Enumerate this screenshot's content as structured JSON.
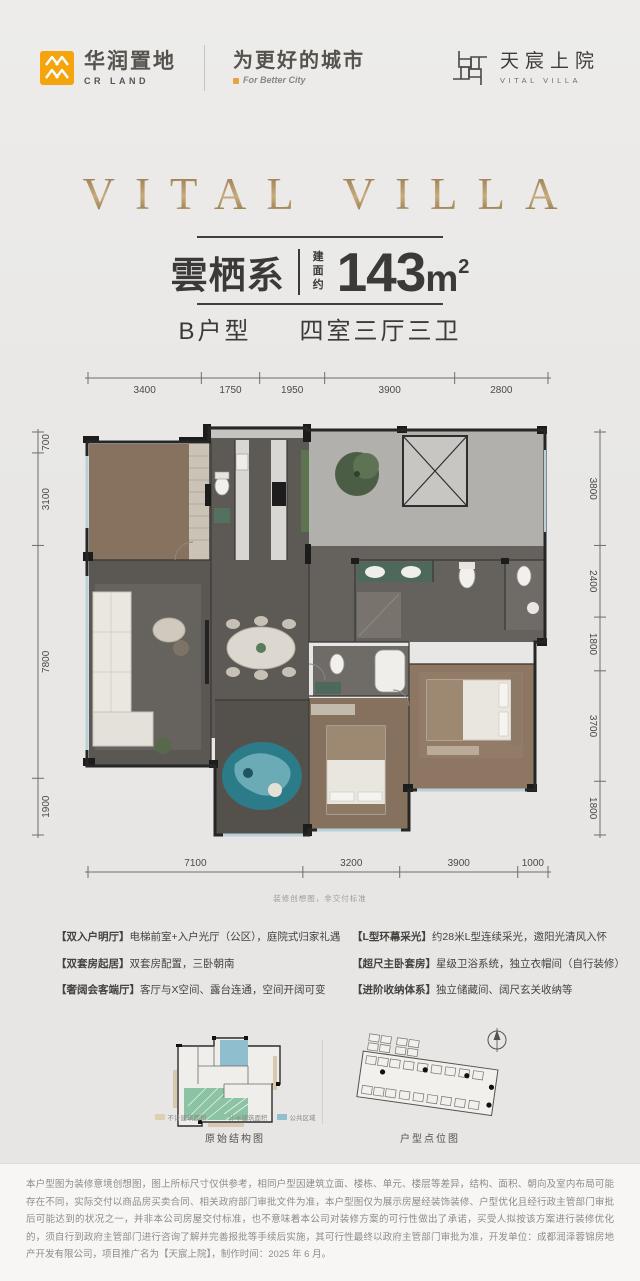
{
  "header": {
    "crland": {
      "name": "华润置地",
      "sub": "CR LAND",
      "slogan": "为更好的城市",
      "slogan_en": "For Better City"
    },
    "project": {
      "name": "天宸上院",
      "name_en": "VITAL VILLA"
    }
  },
  "hero": {
    "title": "VITAL VILLA"
  },
  "product": {
    "series": "雲栖系",
    "area_prefix": [
      "建",
      "面",
      "约"
    ],
    "area_value": "143",
    "area_unit": "m",
    "area_sup": "2",
    "type_label": "B户型",
    "layout": "四室三厅三卫"
  },
  "floorplan": {
    "caption": "装修创想图，非交付标准",
    "dims_top": [
      3400,
      1750,
      1950,
      3900,
      2800
    ],
    "dims_bottom": [
      7100,
      3200,
      3900,
      1000
    ],
    "dims_left": [
      700,
      3100,
      7800,
      1900
    ],
    "dims_right": [
      3800,
      2400,
      1800,
      3700,
      1800
    ]
  },
  "features": {
    "left": [
      {
        "tag": "【双入户明厅】",
        "text": "电梯前室+入户光厅（公区），庭院式归家礼遇"
      },
      {
        "tag": "【双套房起居】",
        "text": "双套房配置，三卧朝南"
      },
      {
        "tag": "【奢阔会客端厅】",
        "text": "客厅与X空间、露台连通，空间开阔可变"
      }
    ],
    "right": [
      {
        "tag": "【L型环幕采光】",
        "text": "约28米L型连续采光，邀阳光清风入怀"
      },
      {
        "tag": "【超尺主卧套房】",
        "text": "星级卫浴系统，独立衣帽间（自行装修）"
      },
      {
        "tag": "【进阶收纳体系】",
        "text": "独立储藏间、阔尺玄关收纳等"
      }
    ]
  },
  "diagrams": {
    "legend": [
      {
        "label": "不计建筑面积",
        "color": "#ddcfb2"
      },
      {
        "label": "计半建筑面积",
        "color": "#8cc3a4"
      },
      {
        "label": "公共区域",
        "color": "#92bfcd"
      }
    ],
    "left_caption": "原始结构图",
    "right_caption": "户型点位图"
  },
  "disclaimer": "本户型图为装修意境创想图，图上所标尺寸仅供参考，相同户型因建筑立面、楼栋、单元、楼层等差异，结构、面积、朝向及室内布局可能存在不同，实际交付以商品房买卖合同、相关政府部门审批文件为准，本户型图仅为展示房屋经装饰装修、户型优化且经行政主管部门审批后可能达到的状况之一，并非本公司房屋交付标准，也不意味着本公司对装修方案的可行性做出了承诺，买受人拟按该方案进行装修优化的，须自行到政府主管部门进行咨询了解并完善报批等手续后实施，其可行性最终以政府主管部门审批为准，开发单位：成都润泽蓉锦房地产开发有限公司，项目推广名为【天宸上院】，制作时间：2025 年 6 月。",
  "colors": {
    "title_gold": "#a5854f",
    "crland_yellow": "#f4a40c",
    "legend_tan": "#ddcfb2",
    "legend_green": "#8cc3a4",
    "legend_blue": "#92bfcd",
    "art_teal": "#2c7b88"
  }
}
